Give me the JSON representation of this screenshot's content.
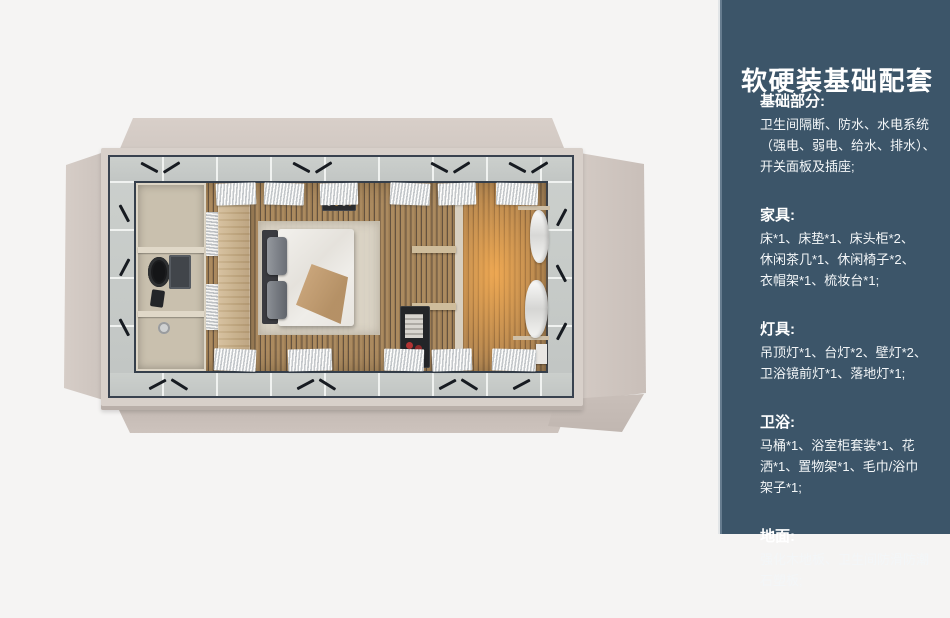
{
  "palette": {
    "page_background": "#f5f4f3",
    "sidebar_background": "#3c5569",
    "sidebar_accent_strip": "#667c8f",
    "sidebar_text": "#ffffff",
    "flap_beige": "#d2c9c3",
    "steel_frame": "#39424f",
    "glass_band": "#c6cac7",
    "wood_floor": "#ab8a5f",
    "warm_glow": "#f0a858"
  },
  "floorplan": {
    "view": "top-down render of modular cabin guest room",
    "zones": [
      "bathroom",
      "bedroom",
      "sunlit-lounge"
    ]
  },
  "sidebar": {
    "title": "软硬装基础配套",
    "sections": [
      {
        "heading": "基础部分:",
        "body": "卫生间隔断、防水、水电系统\n（强电、弱电、给水、排水）、\n开关面板及插座;"
      },
      {
        "heading": "家具:",
        "body": "床*1、床垫*1、床头柜*2、\n休闲茶几*1、休闲椅子*2、\n衣帽架*1、梳妆台*1;"
      },
      {
        "heading": "灯具:",
        "body": "吊顶灯*1、台灯*2、壁灯*2、\n卫浴镜前灯*1、落地灯*1;"
      },
      {
        "heading": "卫浴:",
        "body": "马桶*1、浴室柜套装*1、花\n洒*1、置物架*1、毛巾/浴巾\n架子*1;"
      },
      {
        "heading": "地面:",
        "body": "强化木地板、卫生间防滑防潮\n石塑板;"
      }
    ]
  }
}
